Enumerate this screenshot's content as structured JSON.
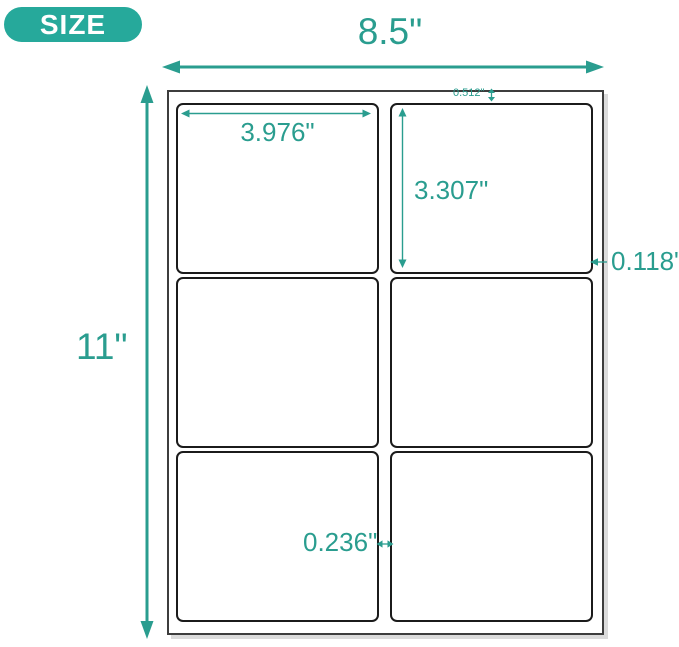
{
  "badge": {
    "label": "SIZE"
  },
  "colors": {
    "teal": "#2a9d8f",
    "badge-bg": "#26a99b",
    "badge-text": "#ffffff",
    "sheet-line": "#3d3d3d",
    "label-line": "#1b1b1b",
    "bg": "#ffffff"
  },
  "sheet": {
    "columns": 2,
    "rows": 3,
    "label_count": 6
  },
  "dimensions": {
    "sheet_width": "8.5\"",
    "sheet_height": "11\"",
    "label_width": "3.976\"",
    "label_height": "3.307\"",
    "top_margin": "0.512\"",
    "right_margin": "0.118\"",
    "column_gap": "0.236\""
  }
}
